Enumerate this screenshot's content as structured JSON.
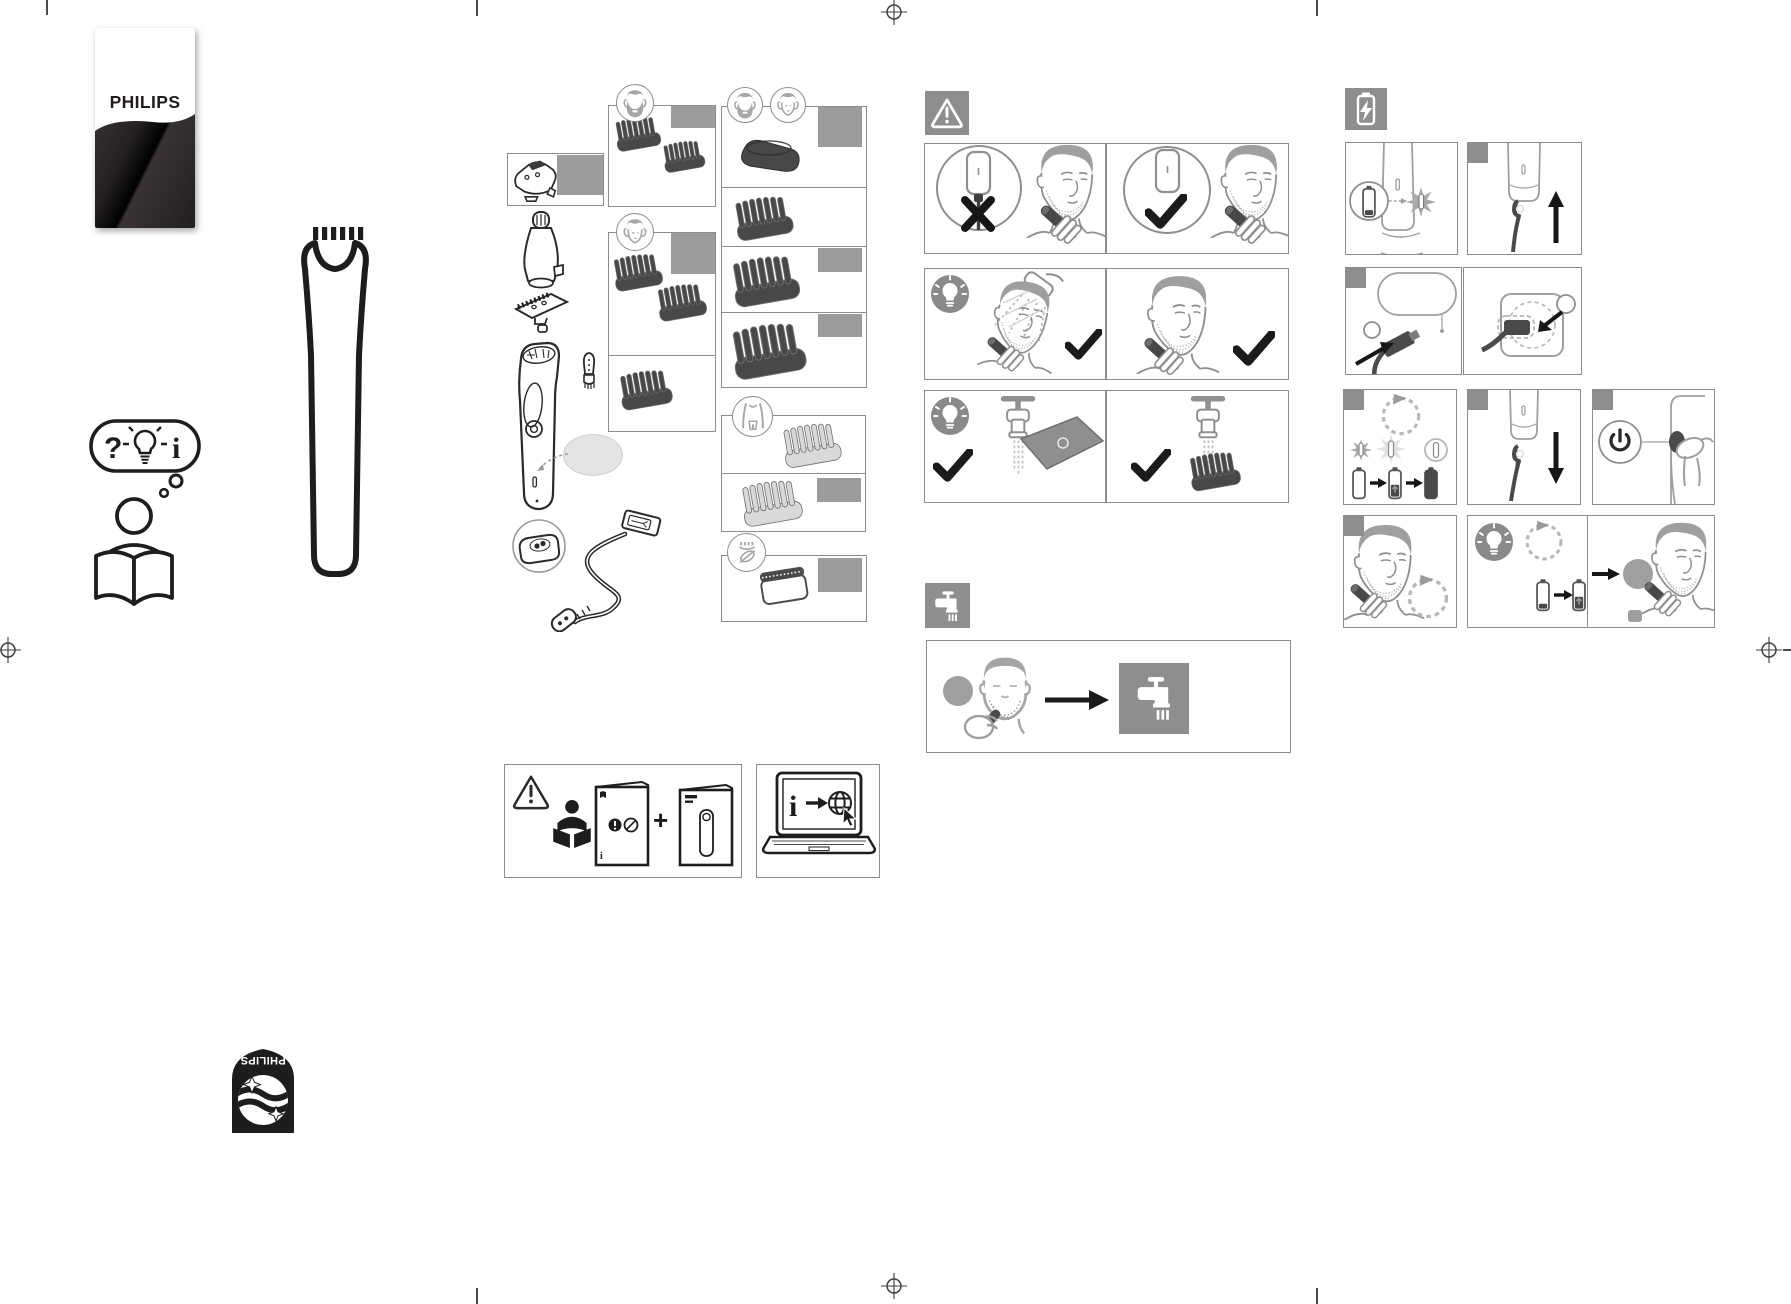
{
  "canvas": {
    "width": 1791,
    "height": 1304,
    "background": "#ffffff"
  },
  "brand": {
    "wordmark": "PHILIPS",
    "shield_wordmark": "PHILIPS"
  },
  "intro": {
    "bubble": {
      "question": "?",
      "bulb": "light-bulb-icon",
      "info": "i"
    },
    "figure": "person-reading-book-icon",
    "device": "trimmer-outline-drawing"
  },
  "colors": {
    "ink": "#1d1d1f",
    "outline": "#8c8c8c",
    "figure_gray": "#9f9f9f",
    "attachment_dark": "#484848",
    "label_gray": "#9c9c9c",
    "icon_square_gray": "#8e8e8e",
    "light_attachment": "#d9d9d9",
    "callout_gray": "#e4e4e4",
    "card_dark": "#2f2a2b"
  },
  "whats_in_box": {
    "device_parts": [
      "trimmer-head",
      "nose-trimmer-attachment",
      "blade-unit",
      "handle-body",
      "cleaning-brush",
      "callout-ellipse",
      "charging-stand",
      "usb-cable"
    ],
    "groups": [
      {
        "header_icons": [
          "stubble-face-icon"
        ],
        "label": "gray-model-label",
        "items": [
          "stubble-comb",
          "stubble-comb"
        ]
      },
      {
        "header_icons": [
          "clean-face-icon"
        ],
        "label": "gray-model-label",
        "items": [
          "hair-comb",
          "hair-comb",
          "hair-comb"
        ]
      },
      {
        "header_icons": [
          "beard-face-icon",
          "clean-face-icon"
        ],
        "labels": 3,
        "items": [
          "skin-guard",
          "beard-comb",
          "beard-comb",
          "beard-comb"
        ]
      },
      {
        "header_icons": [
          "body-torso-icon"
        ],
        "labels": 1,
        "items": [
          "body-comb",
          "body-comb"
        ]
      },
      {
        "header_icons": [
          "foil-shaver-leaf-icon"
        ],
        "labels": 1,
        "items": [
          "foil-shaver-head"
        ]
      }
    ]
  },
  "documentation": {
    "plus": "+",
    "booklet_info": "i",
    "laptop_info": "i",
    "icons": [
      "warning-triangle-outline-icon",
      "person-reading-solid-icon",
      "safety-booklet-icon",
      "product-leaflet-icon",
      "laptop-online-info-icon"
    ]
  },
  "safety": {
    "icon": "warning-triangle-icon",
    "rows": [
      {
        "left": "do-not-use-while-plugged-in",
        "right": "use-cordless-ok"
      },
      {
        "left": "tip-shower-use-ok",
        "right": "dry-use-ok"
      },
      {
        "left": "tip-rinse-handle-under-tap",
        "right": "rinse-attachment-under-tap"
      }
    ]
  },
  "cleaning": {
    "icon": "tap-water-icon",
    "sequence": [
      "after-trimming-stubble-face",
      "arrow-right",
      "rinse-under-tap-square"
    ]
  },
  "charging": {
    "icon": "battery-lightning-icon",
    "steps": [
      "battery-low-indicator-flashes",
      "plug-cord-into-handle",
      "connect-usb-to-adapter",
      "plug-adapter-into-wall-socket",
      "charging-indicator-states-and-progress",
      "unplug-after-charging",
      "press-power-button",
      "runtime-after-charge",
      "recharge-when-low",
      "trim-when-indicator-on"
    ]
  },
  "footer": {
    "emblem": "philips-shield-rotated-180"
  }
}
